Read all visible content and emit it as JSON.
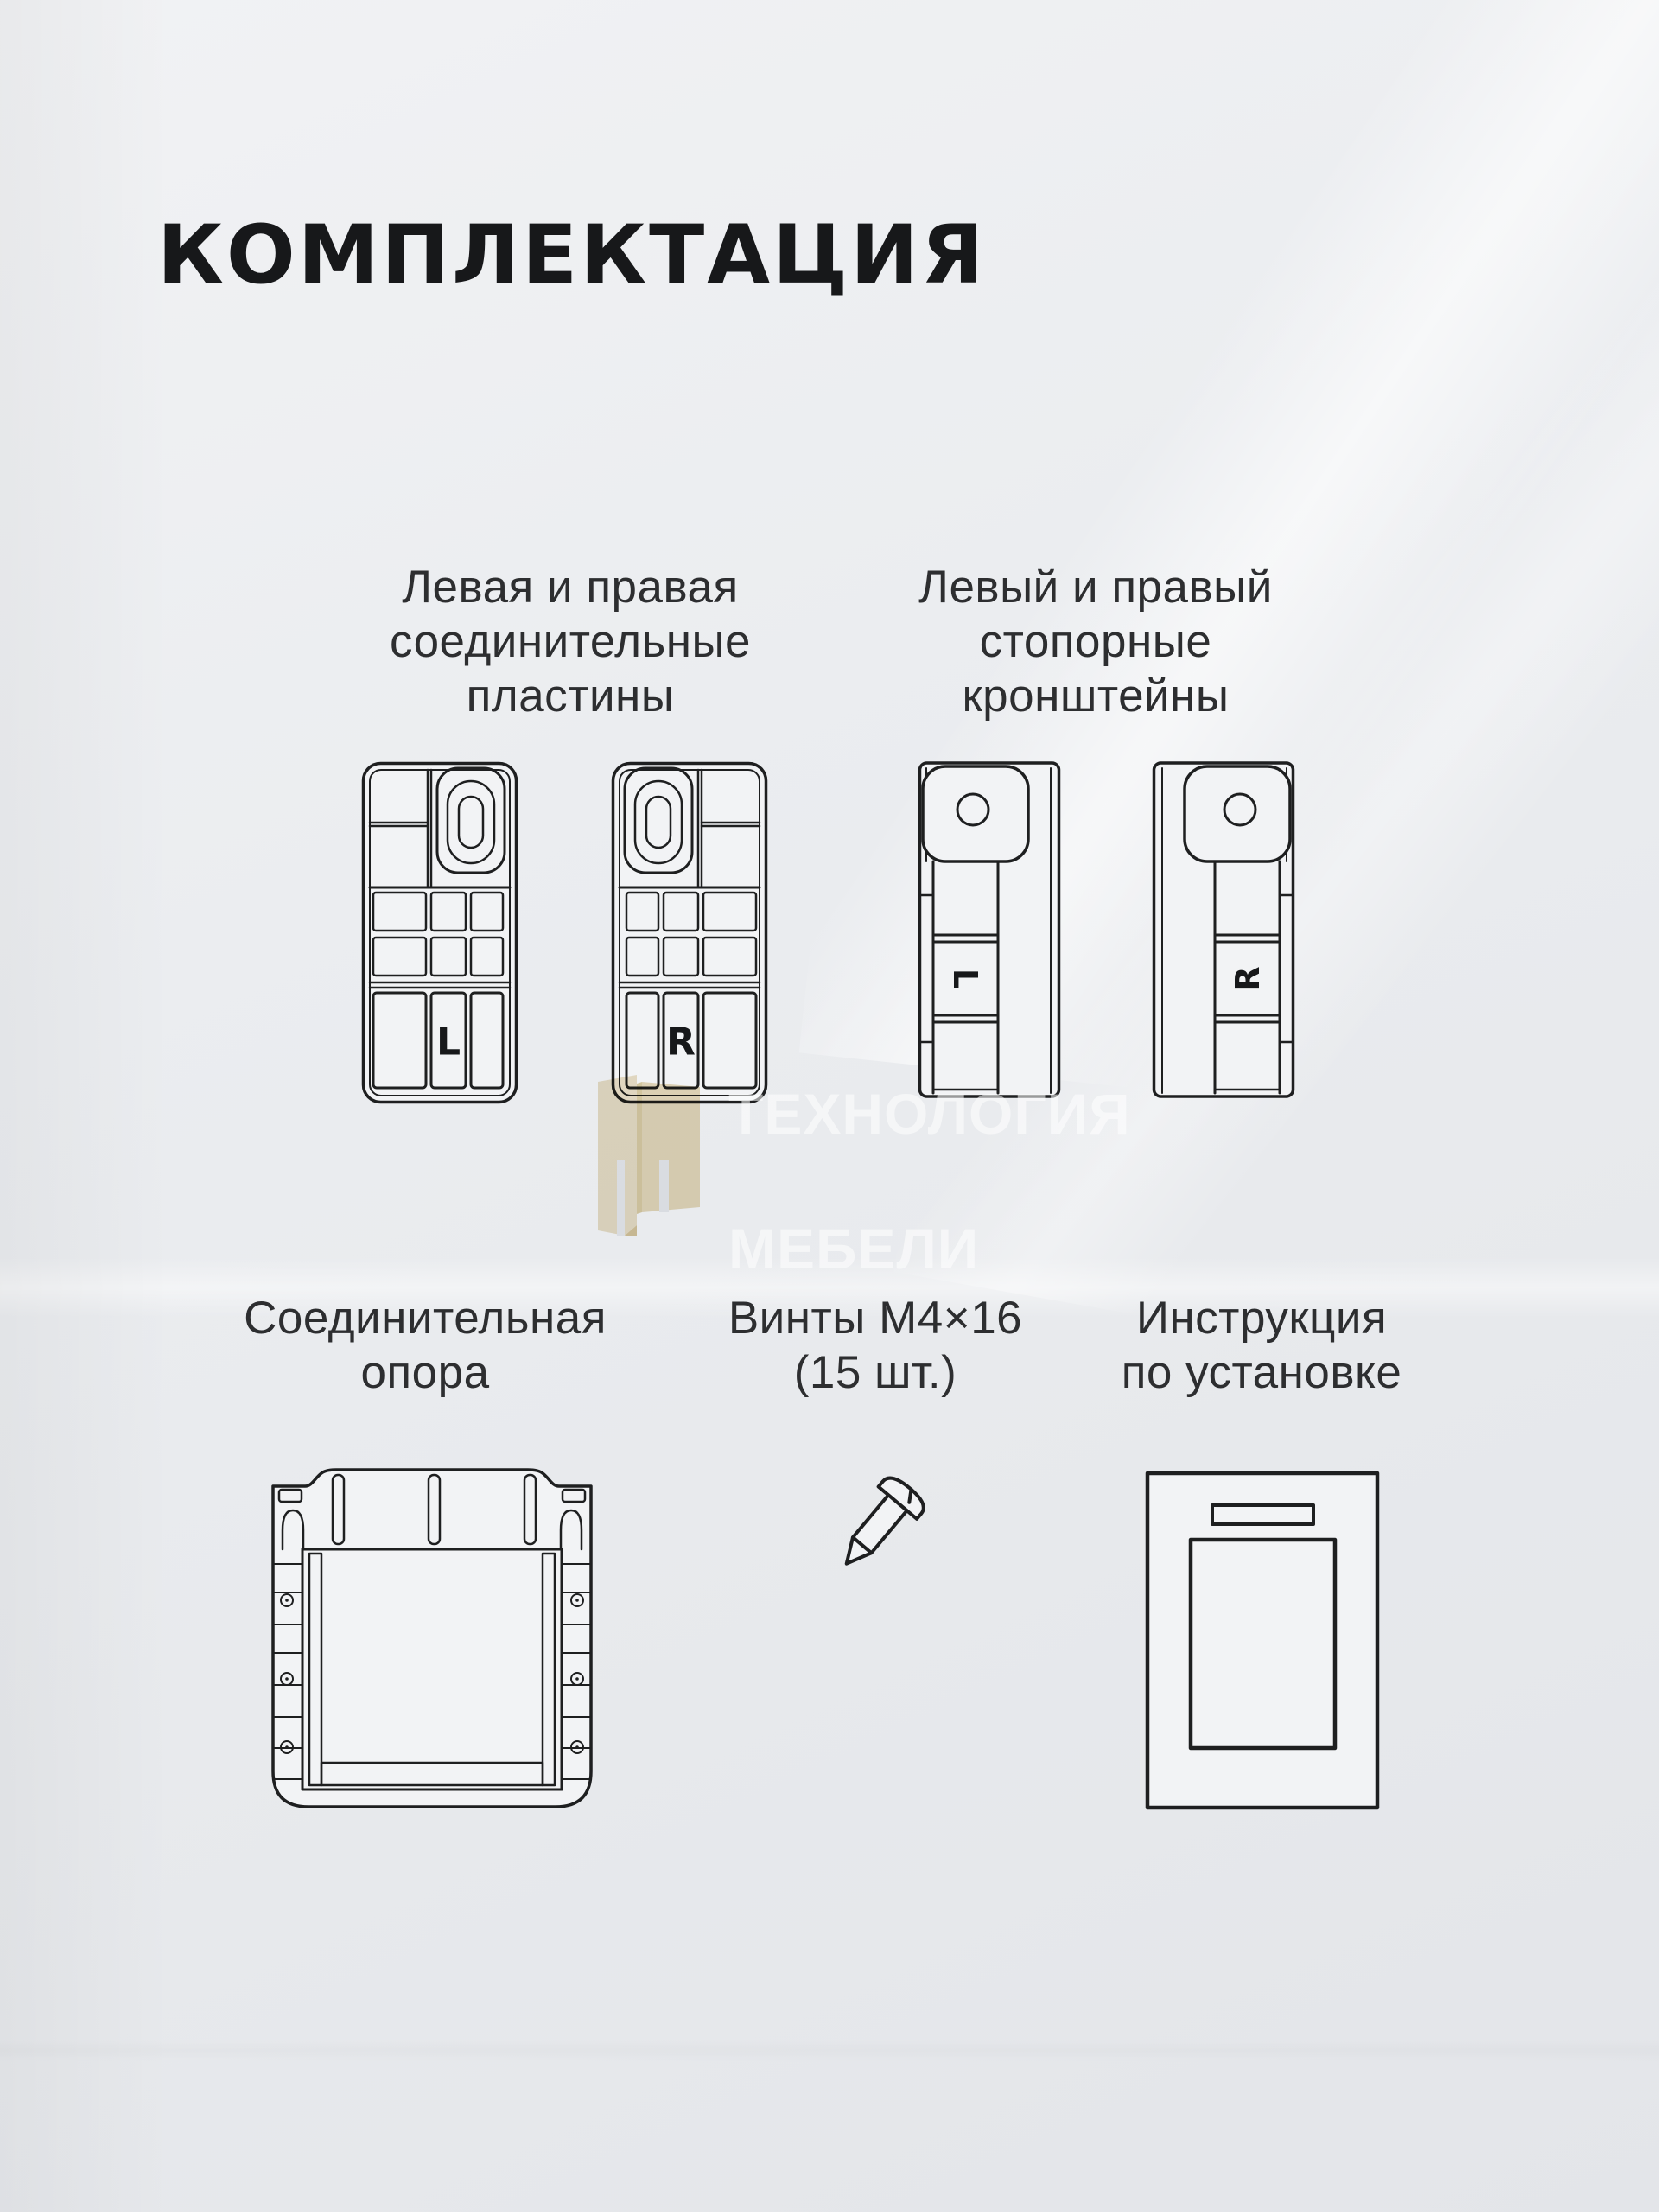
{
  "title": "КОМПЛЕКТАЦИЯ",
  "watermark": {
    "line1": "ТЕХНОЛОГИЯ",
    "line2": "МЕБЕЛИ"
  },
  "colors": {
    "background": "#e9ebee",
    "line_ink": "#1e1f20",
    "label_text": "#2d2e30",
    "watermark_beige_light": "#ebdfc3",
    "watermark_beige_dark": "#e3d4b0",
    "watermark_text": "rgba(255,255,255,0.55)"
  },
  "items": [
    {
      "key": "plates",
      "label": "Левая и правая\nсоединительные\nпластины",
      "left_mark": "L",
      "right_mark": "R"
    },
    {
      "key": "brackets",
      "label": "Левый и правый\nстопорные\nкронштейны",
      "left_mark": "L",
      "right_mark": "R"
    },
    {
      "key": "support",
      "label": "Соединительная\nопора"
    },
    {
      "key": "screws",
      "label": "Винты М4×16\n(15 шт.)"
    },
    {
      "key": "manual",
      "label": "Инструкция\nпо установке"
    }
  ]
}
